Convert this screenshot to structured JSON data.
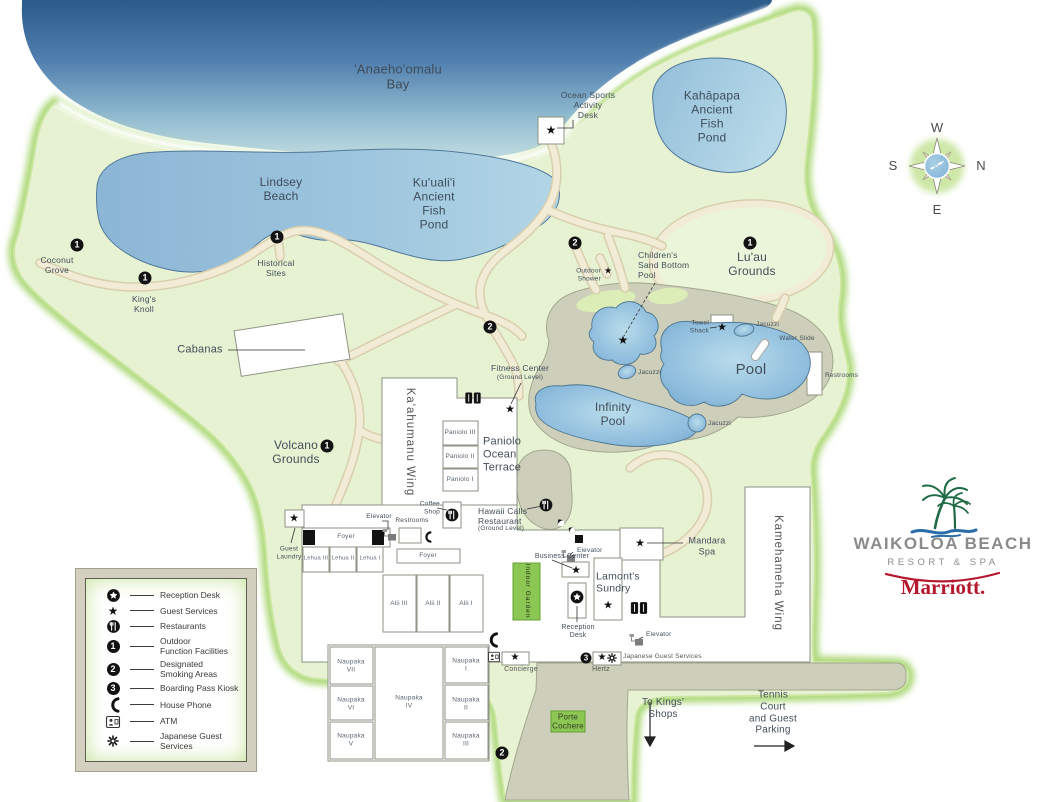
{
  "title": "Waikoloa Beach Resort & Spa map",
  "labels": {
    "bay": "'Anaeho'omalu\nBay",
    "ocean_sports_desk": "Ocean Sports\nActivity\nDesk",
    "kahapapa_pond": "Kahāpapa\nAncient\nFish\nPond",
    "lindsey_beach": "Lindsey\nBeach",
    "kuualii_pond": "Ku'uali'i\nAncient\nFish\nPond",
    "coconut_grove": "Coconut\nGrove",
    "historical_sites": "Historical\nSites",
    "kings_knoll": "King's\nKnoll",
    "childrens_pool": "Children's\nSand Bottom\nPool",
    "luau_grounds": "Lu'au\nGrounds",
    "outdoor_shower": "Outdoor\nShower",
    "cabanas": "Cabanas",
    "towel_shack": "Towel\nShack",
    "jacuzzi": "Jacuzzi",
    "water_slide": "Water Slide",
    "pool": "Pool",
    "restrooms": "Restrooms",
    "infinity_pool": "Infinity\nPool",
    "fitness_center": "Fitness Center",
    "ground_level": "(Ground Level)",
    "volcano_grounds": "Volcano\nGrounds",
    "kaahumanu_wing": "Ka'ahumanu Wing",
    "paniolo_iii": "Paniolo III",
    "paniolo_ii": "Paniolo II",
    "paniolo_i": "Paniolo I",
    "paniolo_terrace": "Paniolo\nOcean\nTerrace",
    "coffee_shop": "Coffee\nShop",
    "elevator": "Elevator",
    "guest_laundry": "Guest\nLaundry",
    "foyer": "Foyer",
    "lehua_iii": "Lehua III",
    "lehua_ii": "Lehua II",
    "lehua_i": "Lehua I",
    "alii_iii": "Alii III",
    "alii_ii": "Alii II",
    "alii_i": "Alii I",
    "hawaii_calls": "Hawaii Calls\nRestaurant",
    "business_center": "Business Center",
    "indoor_garden": "Indoor Garden",
    "lamonts_sundry": "Lamont's\nSundry",
    "reception_desk": "Reception\nDesk",
    "mandara_spa": "Mandara\nSpa",
    "kamehameha_wing": "Kamehameha Wing",
    "japanese_guest_services": "Japanese Guest Services",
    "naupaka_vii": "Naupaka\nVII",
    "naupaka_vi": "Naupaka\nVI",
    "naupaka_v": "Naupaka\nV",
    "naupaka_iv": "Naupaka\nIV",
    "naupaka_i": "Naupaka\nI",
    "naupaka_ii": "Naupaka\nII",
    "naupaka_iii": "Naupaka\nIII",
    "concierge": "Concierge",
    "hertz": "Hertz",
    "porte_cochere": "Porte\nCochere",
    "to_kings_shops": "To Kings'\nShops",
    "tennis_parking": "Tennis\nCourt\nand Guest\nParking"
  },
  "markers": {
    "star": "★",
    "n1": "1",
    "n2": "2",
    "n3": "3"
  },
  "compass": {
    "top": "W",
    "right": "N",
    "bottom": "E",
    "left": "S"
  },
  "legend": {
    "items": [
      {
        "icon": "reception-desk-icon",
        "label": "Reception Desk"
      },
      {
        "icon": "guest-services-icon",
        "label": "Guest Services"
      },
      {
        "icon": "restaurants-icon",
        "label": "Restaurants"
      },
      {
        "icon": "outdoor-function-facilities-icon",
        "label": "Outdoor\nFunction Facilities"
      },
      {
        "icon": "designated-smoking-areas-icon",
        "label": "Designated\nSmoking Areas"
      },
      {
        "icon": "boarding-pass-kiosk-icon",
        "label": "Boarding Pass Kiosk"
      },
      {
        "icon": "house-phone-icon",
        "label": "House Phone"
      },
      {
        "icon": "atm-icon",
        "label": "ATM"
      },
      {
        "icon": "japanese-guest-services-icon",
        "label": "Japanese Guest\nServices"
      }
    ]
  },
  "logo": {
    "name": "WAIKOLOA BEACH",
    "tagline": "RESORT & SPA",
    "brand": "Marriott."
  },
  "colors": {
    "ocean": "#2c5a89",
    "pond": "#8cb6d5",
    "land": "#e6f2d2",
    "path": "#f2ebd6",
    "deck": "#cdcfba",
    "accent_green": "#8cc653",
    "marriott_red": "#b5182e",
    "logo_gray": "#8b8b8b"
  }
}
